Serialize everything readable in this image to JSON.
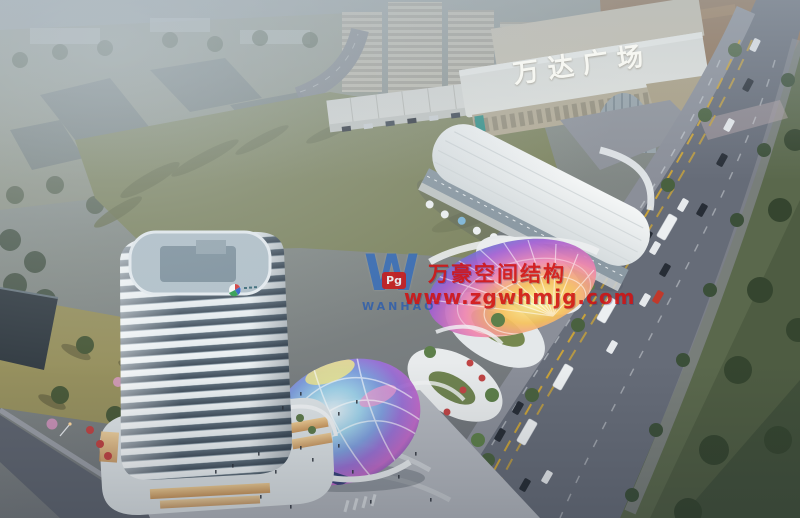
{
  "signage": {
    "wanda_plaza": "万达广场"
  },
  "watermark": {
    "logo_letter": "W",
    "logo_badge": "Pg",
    "logo_name": "WANHAO",
    "brand_cn": "万豪空间结构",
    "url": "www.zgwhmjg.com",
    "text_color": "#d01212",
    "logo_color": "#2e6cc2"
  },
  "colors": {
    "field": "#7f8661",
    "road": "#666c78",
    "roadside_green": "#5a684c",
    "plaza": "#b4b8bf",
    "tower_roof": "#b3c2cb",
    "wanda_roof": "#8f7053",
    "haze": "#9aa5ab",
    "dome_palette": "#9fd4ec #7e9fe0 #9a6fd6 #c167c9",
    "canopy_palette": "#fdf4a0 #f6c25c #ef86b0 #a25fd3 #5a77cf"
  }
}
